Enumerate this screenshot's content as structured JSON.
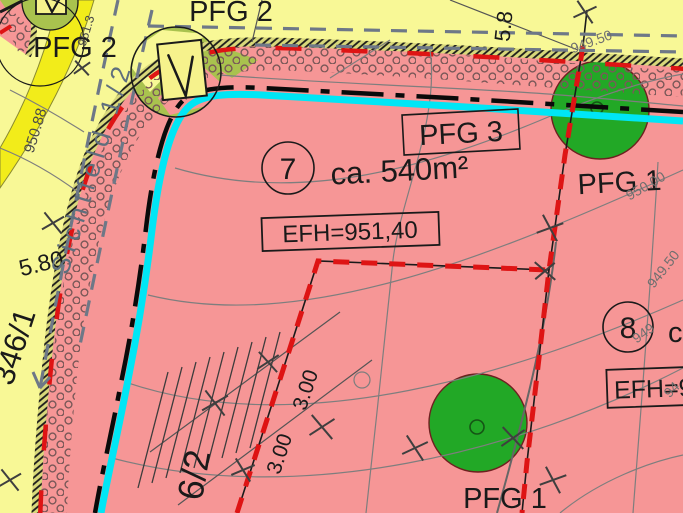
{
  "plan": {
    "colors": {
      "residential_fill": "#F69696",
      "road_fill": "#F8F896",
      "road_marking_fill": "#F2EC1A",
      "green_symbol_fill": "#A9C24E",
      "tree_fill": "#22A826",
      "utility_cyan": "#00E6F5",
      "building_limit_red": "#DE1414"
    },
    "areas": {
      "pfg2_left": "PFG 2",
      "pfg2_top": "PFG 2",
      "pfg3": "PFG 3",
      "pfg1_right": "PFG 1",
      "pfg1_bottom": "PFG 1"
    },
    "plots": {
      "plot7": {
        "number": "7",
        "area": "ca. 540m²",
        "height": "EFH=951,40"
      },
      "plot8": {
        "number": "8",
        "area_partial": "ca.",
        "height_partial": "EFH=9"
      }
    },
    "parcels": {
      "left_road": "346/1",
      "bottom_left": "6/2"
    },
    "dimensions": {
      "road_width_left": "5.80",
      "road_width_top": "5.8",
      "offset_a": "3.00",
      "offset_b": "3.00"
    },
    "sight_line_label": "Sichtfeld 1/2",
    "spot_heights": {
      "a": "951.3",
      "b": "950.88"
    },
    "contour_labels": {
      "c950_00": "950.00",
      "c949_50_top": "949.50",
      "c949_50_mid": "949.50",
      "c949_partial": "949",
      "c94_partial": "94"
    }
  }
}
